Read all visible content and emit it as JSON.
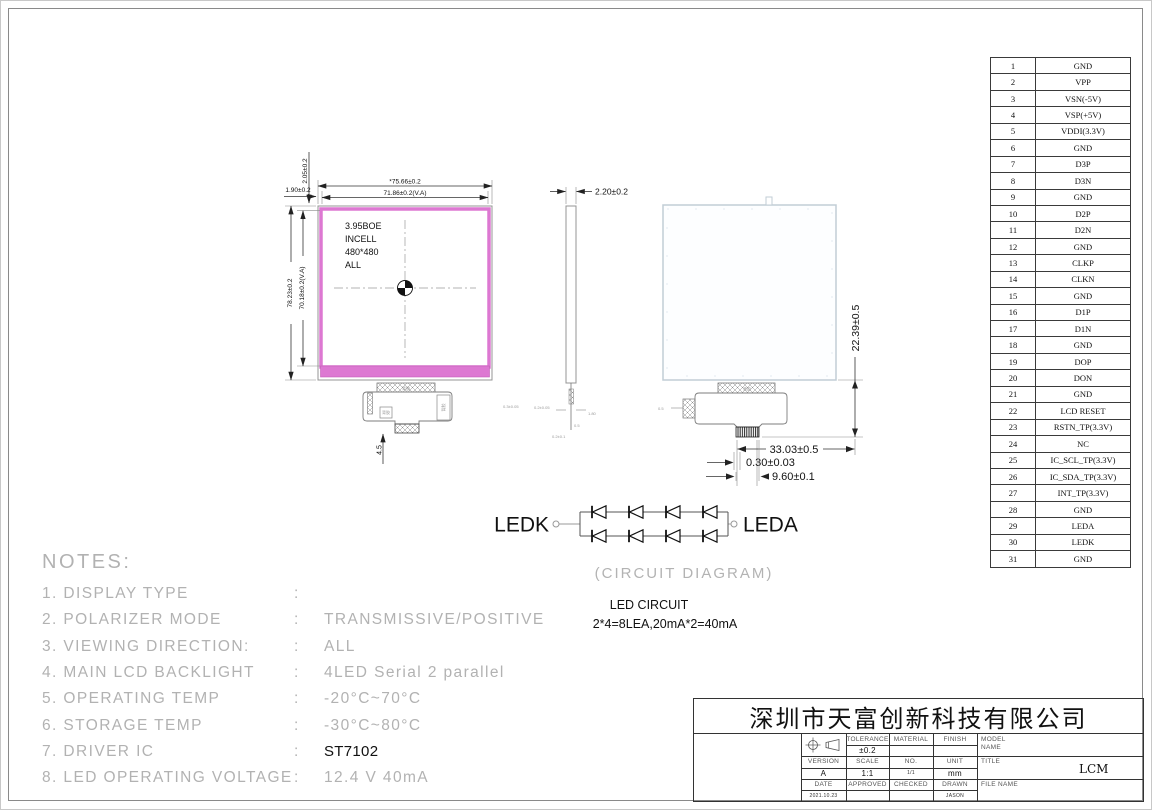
{
  "front_view": {
    "label": [
      "3.95BOE",
      "INCELL",
      "480*480",
      "ALL"
    ],
    "dims": {
      "outer_width": "*75.66±0.2",
      "va_width": "71.86±0.2(V.A)",
      "outer_height": "78.23±0.2",
      "va_height": "70.18±0.2(V.A)",
      "top_gap": "2.05±0.2",
      "left_gap": "1.90±0.2",
      "fpc_drop": "4.5"
    }
  },
  "side_view": {
    "thickness": "2.20±0.2"
  },
  "back_view": {
    "dims": {
      "tail_height": "22.39±0.5",
      "tail_width": "33.03±0.5",
      "pin_pitch": "0.30±0.03",
      "connector_width": "9.60±0.1"
    }
  },
  "micro": {
    "m1": "0.3±0.05",
    "m2": "0.2±0.05",
    "m3": "1.80",
    "m4": "0.5",
    "m5": "0.2±0.1",
    "m6": "0.5",
    "tag": "背胶"
  },
  "led_circuit": {
    "left_terminal": "LEDK",
    "right_terminal": "LEDA",
    "caption": "(CIRCUIT DIAGRAM)",
    "title": "LED CIRCUIT",
    "formula": "2*4=8LEA,20mA*2=40mA"
  },
  "notes": {
    "heading": "NOTES:",
    "items": [
      {
        "label": "1. DISPLAY TYPE",
        "colon": ":",
        "value": ""
      },
      {
        "label": "2. POLARIZER MODE",
        "colon": ":",
        "value": "TRANSMISSIVE/POSITIVE"
      },
      {
        "label": "3. VIEWING DIRECTION:",
        "colon": ":",
        "value": "ALL"
      },
      {
        "label": "4. MAIN LCD BACKLIGHT",
        "colon": ":",
        "value": "4LED Serial 2 parallel"
      },
      {
        "label": "5. OPERATING TEMP",
        "colon": ":",
        "value": "-20°C~70°C"
      },
      {
        "label": "6. STORAGE TEMP",
        "colon": ":",
        "value": "-30°C~80°C"
      },
      {
        "label": "7. DRIVER IC",
        "colon": ":",
        "value": "ST7102",
        "style": "ink"
      },
      {
        "label": "8. LED OPERATING VOLTAGE",
        "colon": ":",
        "value": "12.4 V 40mA"
      }
    ]
  },
  "pin_table": {
    "rows": [
      {
        "no": "1",
        "name": "GND"
      },
      {
        "no": "2",
        "name": "VPP"
      },
      {
        "no": "3",
        "name": "VSN(-5V)"
      },
      {
        "no": "4",
        "name": "VSP(+5V)"
      },
      {
        "no": "5",
        "name": "VDDI(3.3V)"
      },
      {
        "no": "6",
        "name": "GND"
      },
      {
        "no": "7",
        "name": "D3P"
      },
      {
        "no": "8",
        "name": "D3N"
      },
      {
        "no": "9",
        "name": "GND"
      },
      {
        "no": "10",
        "name": "D2P"
      },
      {
        "no": "11",
        "name": "D2N"
      },
      {
        "no": "12",
        "name": "GND"
      },
      {
        "no": "13",
        "name": "CLKP"
      },
      {
        "no": "14",
        "name": "CLKN"
      },
      {
        "no": "15",
        "name": "GND"
      },
      {
        "no": "16",
        "name": "D1P"
      },
      {
        "no": "17",
        "name": "D1N"
      },
      {
        "no": "18",
        "name": "GND"
      },
      {
        "no": "19",
        "name": "DOP"
      },
      {
        "no": "20",
        "name": "DON"
      },
      {
        "no": "21",
        "name": "GND"
      },
      {
        "no": "22",
        "name": "LCD RESET"
      },
      {
        "no": "23",
        "name": "RSTN_TP(3.3V)"
      },
      {
        "no": "24",
        "name": "NC"
      },
      {
        "no": "25",
        "name": "IC_SCL_TP(3.3V)"
      },
      {
        "no": "26",
        "name": "IC_SDA_TP(3.3V)"
      },
      {
        "no": "27",
        "name": "INT_TP(3.3V)"
      },
      {
        "no": "28",
        "name": "GND"
      },
      {
        "no": "29",
        "name": "LEDA"
      },
      {
        "no": "30",
        "name": "LEDK"
      },
      {
        "no": "31",
        "name": "GND"
      }
    ]
  },
  "title_block": {
    "company": "深圳市天富创新科技有限公司",
    "tolerance_label": "TOLERANCE",
    "tolerance_value": "±0.2",
    "material_label": "MATERIAL",
    "finish_label": "FINISH",
    "model_label": "MODEL",
    "model_label2": "NAME",
    "version_label": "VERSION",
    "version_value": "A",
    "scale_label": "SCALE",
    "scale_value": "1:1",
    "no_label": "NO.",
    "no_value": "1/1",
    "unit_label": "UNIT",
    "unit_value": "mm",
    "title_label": "TITLE",
    "title_value": "LCM",
    "date_label": "DATE",
    "date_value": "2021.10.23",
    "approved_label": "APPROVED",
    "checked_label": "CHECKED",
    "drawn_label": "DRAWN",
    "drawn_value": "JASON",
    "file_label": "FILE NAME"
  },
  "colors": {
    "pink": "#dd78d2",
    "pink_edge": "#c460b8",
    "panel_outline": "#c2cdd6",
    "cad_gray": "#b3b3b3"
  }
}
